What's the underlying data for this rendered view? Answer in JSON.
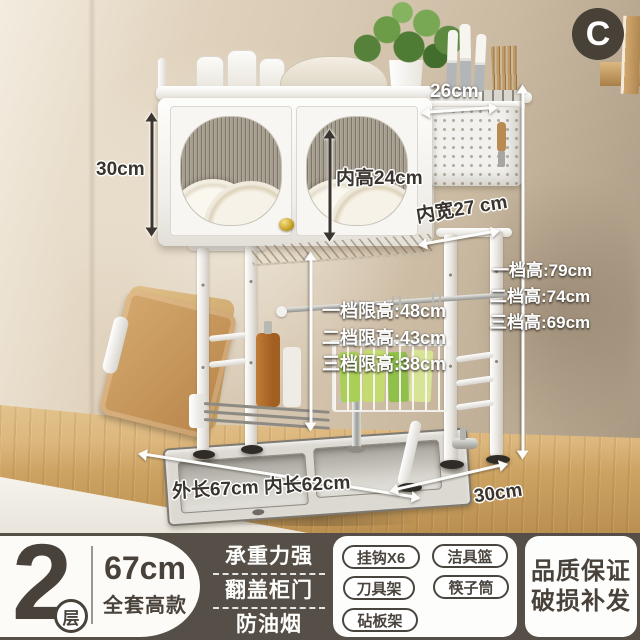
{
  "variant_badge": "C",
  "photo": {
    "annotations": {
      "cabinet_height": "30cm",
      "top_depth": "26cm",
      "inner_height": "内高24cm",
      "inner_width": "内宽27 cm",
      "limit_heights": [
        "一档限高:48cm",
        "二档限高:43cm",
        "三档限高:38cm"
      ],
      "tier_heights": [
        "一档高:79cm",
        "二档高:74cm",
        "三档高:69cm"
      ],
      "length": "外长67cm 内长62cm",
      "depth": "30cm"
    }
  },
  "banner": {
    "tier_number": "2",
    "tier_unit": "层",
    "set_height": "67cm",
    "set_label": "全套高款",
    "features": [
      "承重力强",
      "翻盖柜门",
      "防油烟"
    ],
    "accessories": [
      "挂钩X6",
      "洁具篮",
      "刀具架",
      "筷子筒",
      "砧板架"
    ],
    "guarantee": [
      "品质保证",
      "破损补发"
    ]
  },
  "colors": {
    "banner_bg": "#554f48",
    "badge_bg": "#474138",
    "text_dark": "#48423b",
    "knob_gold": "#c9a227",
    "wood_counter": "#cda362",
    "wall": "#d8c9b3"
  }
}
